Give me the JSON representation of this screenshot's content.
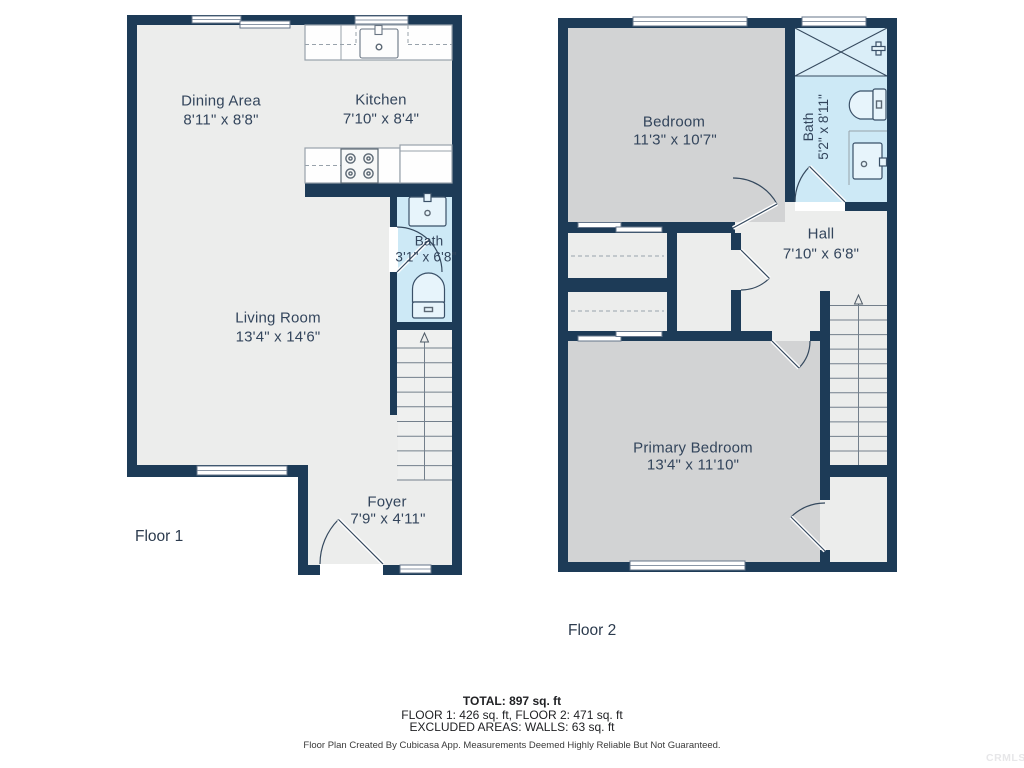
{
  "floor1": {
    "label": "Floor 1",
    "rooms": {
      "dining": {
        "name": "Dining Area",
        "dims": "8'11\" x 8'8\""
      },
      "kitchen": {
        "name": "Kitchen",
        "dims": "7'10\" x 8'4\""
      },
      "bath": {
        "name": "Bath",
        "dims": "3'1\" x 6'8\""
      },
      "living": {
        "name": "Living Room",
        "dims": "13'4\" x 14'6\""
      },
      "foyer": {
        "name": "Foyer",
        "dims": "7'9\" x 4'11\""
      }
    }
  },
  "floor2": {
    "label": "Floor 2",
    "rooms": {
      "bedroom": {
        "name": "Bedroom",
        "dims": "11'3\" x 10'7\""
      },
      "bath": {
        "name": "Bath",
        "dims": "5'2\" x 8'11\""
      },
      "hall": {
        "name": "Hall",
        "dims": "7'10\" x 6'8\""
      },
      "primary": {
        "name": "Primary Bedroom",
        "dims": "13'4\" x 11'10\""
      }
    }
  },
  "summary": {
    "total": "TOTAL: 897 sq. ft",
    "floors": "FLOOR 1: 426 sq. ft, FLOOR 2: 471 sq. ft",
    "excluded": "EXCLUDED AREAS: WALLS: 63 sq. ft"
  },
  "attribution": "Floor Plan Created By Cubicasa App. Measurements Deemed Highly Reliable But Not Guaranteed.",
  "watermark": "CRMLS",
  "colors": {
    "wall": "#1d3b57",
    "floor": "#ecedec",
    "bedroom_floor": "#d2d3d4",
    "bath_floor": "#cde9f6",
    "label_text": "#33455c"
  }
}
